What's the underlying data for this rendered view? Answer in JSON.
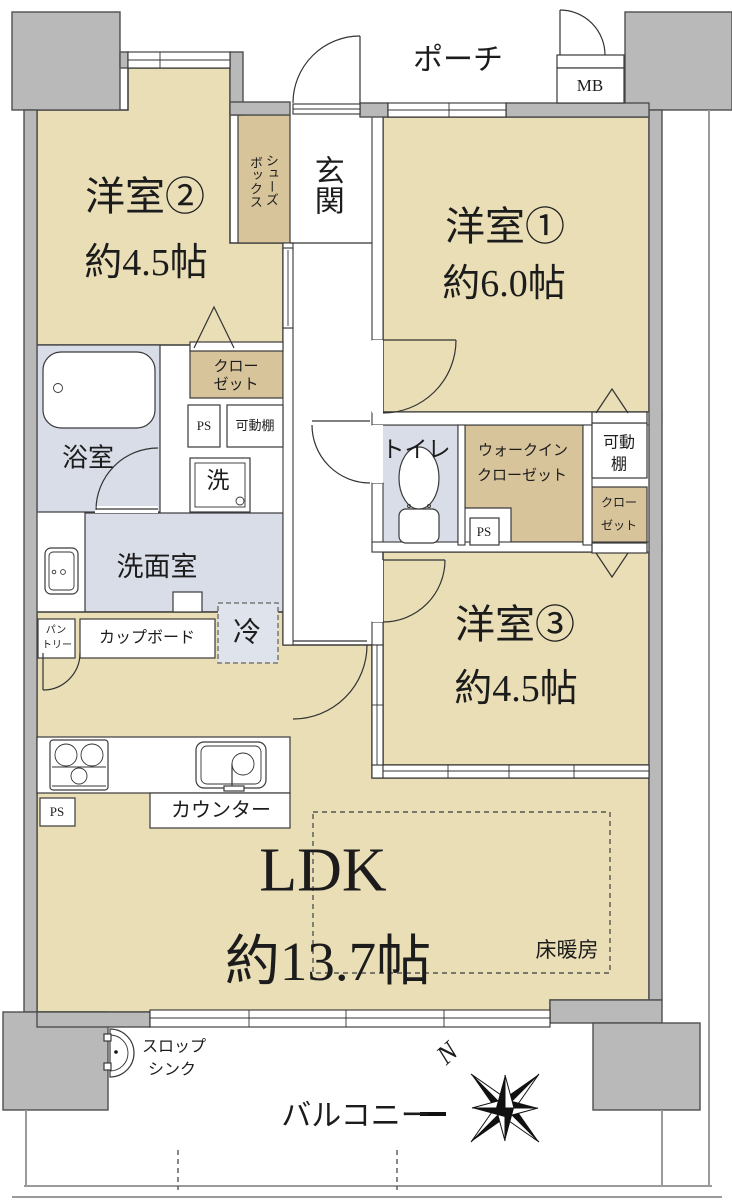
{
  "colors": {
    "room": "#e9deb6",
    "closet": "#d8c49a",
    "wet_area": "#d9dde8",
    "wall": "#b9b9b9",
    "line": "#333333"
  },
  "floorplan": {
    "porch": "ポーチ",
    "meter_box": "MB",
    "entrance": "玄関",
    "shoe_box": {
      "line1": "シューズ",
      "line2": "ボックス"
    },
    "western_room_2": {
      "name": "洋室②",
      "size": "約4.5帖"
    },
    "western_room_1": {
      "name": "洋室①",
      "size": "約6.0帖"
    },
    "western_room_3": {
      "name": "洋室③",
      "size": "約4.5帖"
    },
    "closet_west": {
      "line1": "クロー",
      "line2": "ゼット"
    },
    "ps_west": "PS",
    "shelf_west": "可動棚",
    "bathroom": "浴室",
    "washer": "洗",
    "washroom": "洗面室",
    "toilet": "トイレ",
    "wic": {
      "line1": "ウォークイン",
      "line2": "クローゼット"
    },
    "ps_center": "PS",
    "shelf_east": {
      "line1": "可動",
      "line2": "棚"
    },
    "closet_east": {
      "line1": "クロー",
      "line2": "ゼット"
    },
    "pantry": {
      "line1": "パン",
      "line2": "トリー"
    },
    "cupboard": "カップボード",
    "fridge": "冷",
    "ps_kitchen": "PS",
    "counter": "カウンター",
    "ldk": {
      "name": "LDK",
      "size": "約13.7帖"
    },
    "floor_heating": "床暖房",
    "slop_sink": {
      "line1": "スロップ",
      "line2": "シンク"
    },
    "balcony": "バルコニー",
    "compass_north": "N"
  }
}
